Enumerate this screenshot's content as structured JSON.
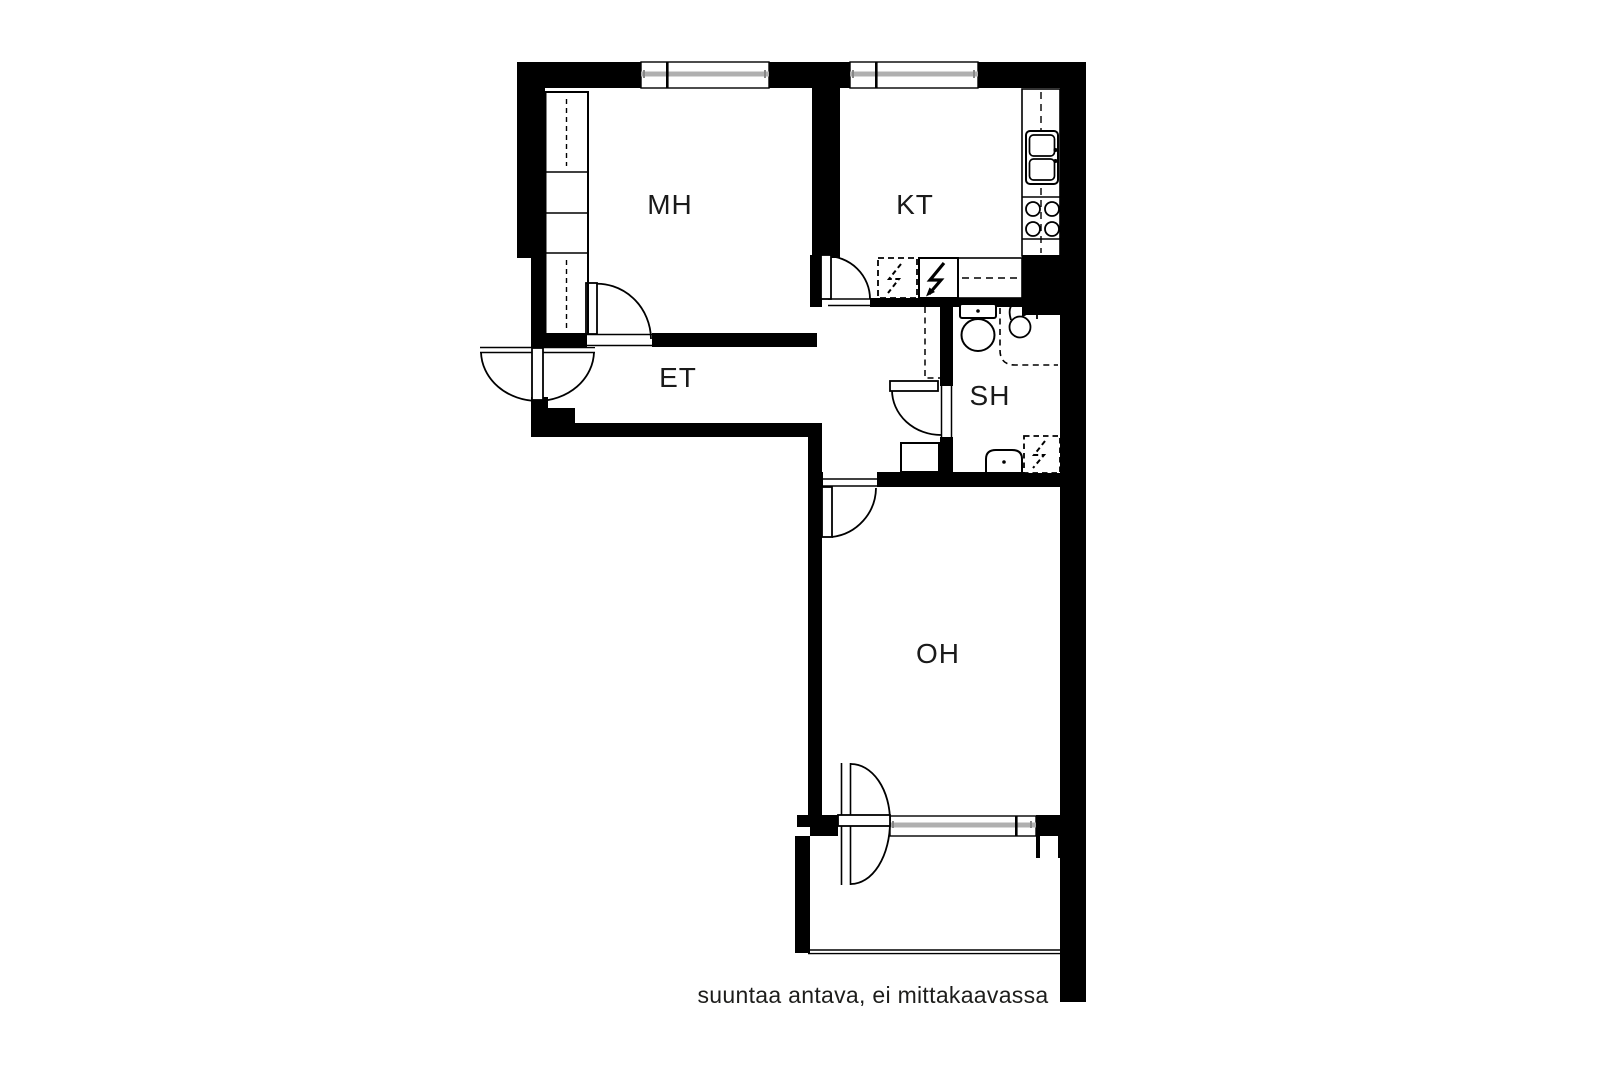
{
  "floorplan": {
    "title": "apartment-floor-plan",
    "rooms": [
      {
        "id": "mh",
        "label": "MH"
      },
      {
        "id": "kt",
        "label": "KT"
      },
      {
        "id": "et",
        "label": "ET"
      },
      {
        "id": "sh",
        "label": "SH"
      },
      {
        "id": "oh",
        "label": "OH"
      }
    ],
    "caption": "suuntaa antava, ei mittakaavassa",
    "colors": {
      "wall": "#000000",
      "glass": "#b0b0b0",
      "background": "#ffffff",
      "text": "#1a1a1a"
    },
    "icons": [
      "toilet-icon",
      "washbasin-sink-icon",
      "corner-sink-icon",
      "washing-machine-reservation-icon",
      "fridge-lightning-icon",
      "appliance-reservation-lightning-icon",
      "stove-icon",
      "kitchen-sink-icon",
      "wardrobe-icon",
      "door-swing-icon",
      "window-icon",
      "shower-area-icon"
    ]
  }
}
